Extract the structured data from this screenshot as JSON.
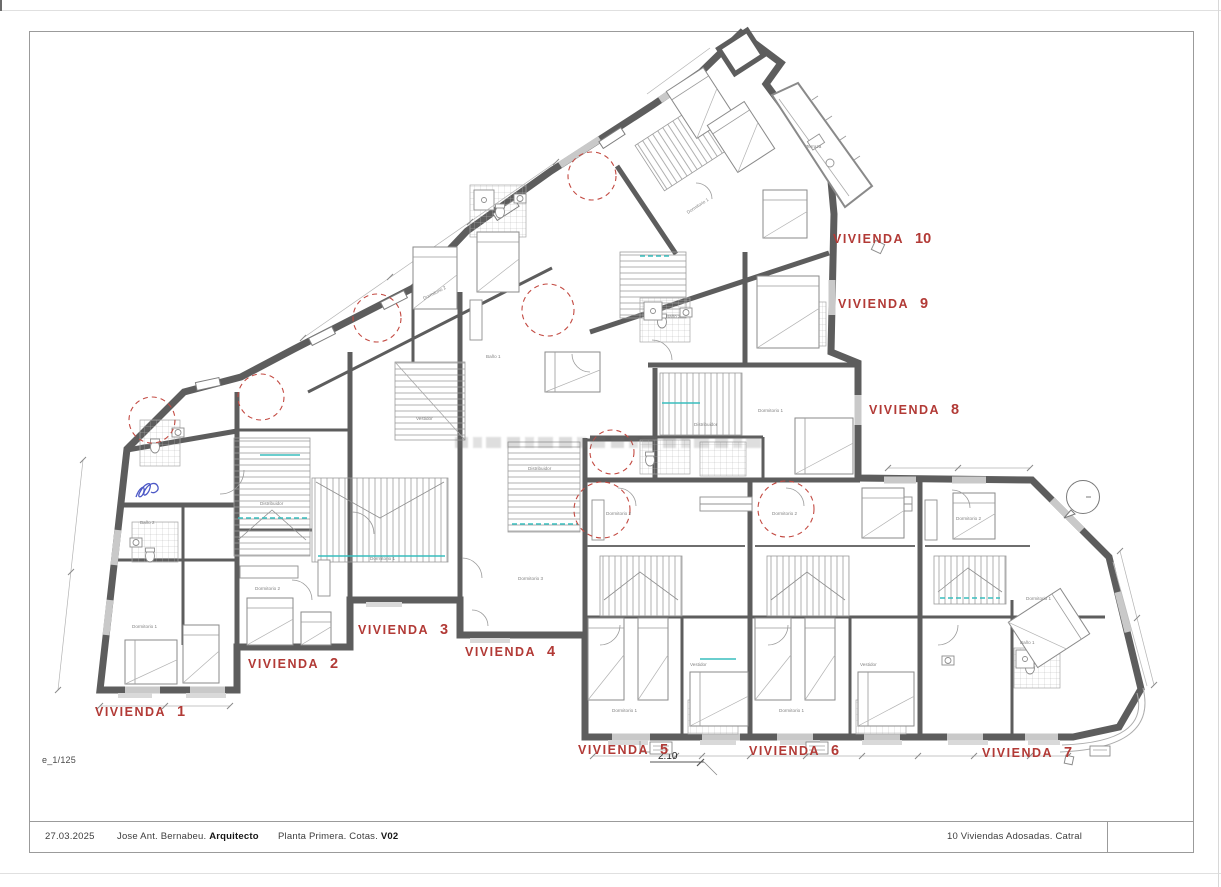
{
  "sheet": {
    "scale_note": "e_1/125",
    "titleblock": {
      "date": "27.03.2025",
      "author": "Jose Ant. Bernabeu.",
      "author_role": "Arquitecto",
      "drawing_title": "Planta Primera. Cotas.",
      "version": "V02",
      "project": "10 Viviendas Adosadas. Catral"
    }
  },
  "plan": {
    "unit_label_prefix": "VIVIENDA",
    "unit_labels": [
      {
        "n": "1",
        "x": 95,
        "y": 704
      },
      {
        "n": "2",
        "x": 248,
        "y": 656
      },
      {
        "n": "3",
        "x": 358,
        "y": 622
      },
      {
        "n": "4",
        "x": 465,
        "y": 644
      },
      {
        "n": "5",
        "x": 578,
        "y": 742
      },
      {
        "n": "6",
        "x": 749,
        "y": 743
      },
      {
        "n": "7",
        "x": 982,
        "y": 745
      },
      {
        "n": "8",
        "x": 869,
        "y": 402
      },
      {
        "n": "9",
        "x": 838,
        "y": 296
      },
      {
        "n": "10",
        "x": 833,
        "y": 231
      }
    ],
    "dimension_callout": "2.10",
    "room_labels": [
      {
        "t": "Dormitorio 1",
        "x": 132,
        "y": 628
      },
      {
        "t": "Baño 2",
        "x": 140,
        "y": 524
      },
      {
        "t": "Dormitorio 2",
        "x": 255,
        "y": 590
      },
      {
        "t": "Distribuidor",
        "x": 260,
        "y": 505
      },
      {
        "t": "Dormitorio 1",
        "x": 370,
        "y": 560
      },
      {
        "t": "Vestidor",
        "x": 416,
        "y": 420
      },
      {
        "t": "Dormitorio 2",
        "x": 424,
        "y": 300,
        "r": -27
      },
      {
        "t": "Baño 1",
        "x": 486,
        "y": 358
      },
      {
        "t": "Distribuidor",
        "x": 528,
        "y": 470
      },
      {
        "t": "Dormitorio 3",
        "x": 518,
        "y": 580
      },
      {
        "t": "Dormitorio 1",
        "x": 688,
        "y": 214,
        "r": -33
      },
      {
        "t": "Terraza",
        "x": 806,
        "y": 148
      },
      {
        "t": "Baño 2",
        "x": 666,
        "y": 318
      },
      {
        "t": "Dormitorio 1",
        "x": 758,
        "y": 412
      },
      {
        "t": "Distribuidor",
        "x": 694,
        "y": 426
      },
      {
        "t": "Dormitorio 2",
        "x": 606,
        "y": 515
      },
      {
        "t": "Dormitorio 1",
        "x": 612,
        "y": 712
      },
      {
        "t": "Vestidor",
        "x": 690,
        "y": 666
      },
      {
        "t": "Dormitorio 2",
        "x": 772,
        "y": 515
      },
      {
        "t": "Dormitorio 1",
        "x": 779,
        "y": 712
      },
      {
        "t": "Vestidor",
        "x": 860,
        "y": 666
      },
      {
        "t": "Dormitorio 2",
        "x": 956,
        "y": 520
      },
      {
        "t": "Baño 1",
        "x": 1020,
        "y": 644
      },
      {
        "t": "Dormitorio 1",
        "x": 1026,
        "y": 600
      }
    ],
    "colors": {
      "wall": "#5d5d5d",
      "thin_line": "#8f8f8f",
      "label_red": "#b23a36",
      "marker_red": "#c34a42",
      "stair_cyan": "#38bdbd"
    }
  }
}
